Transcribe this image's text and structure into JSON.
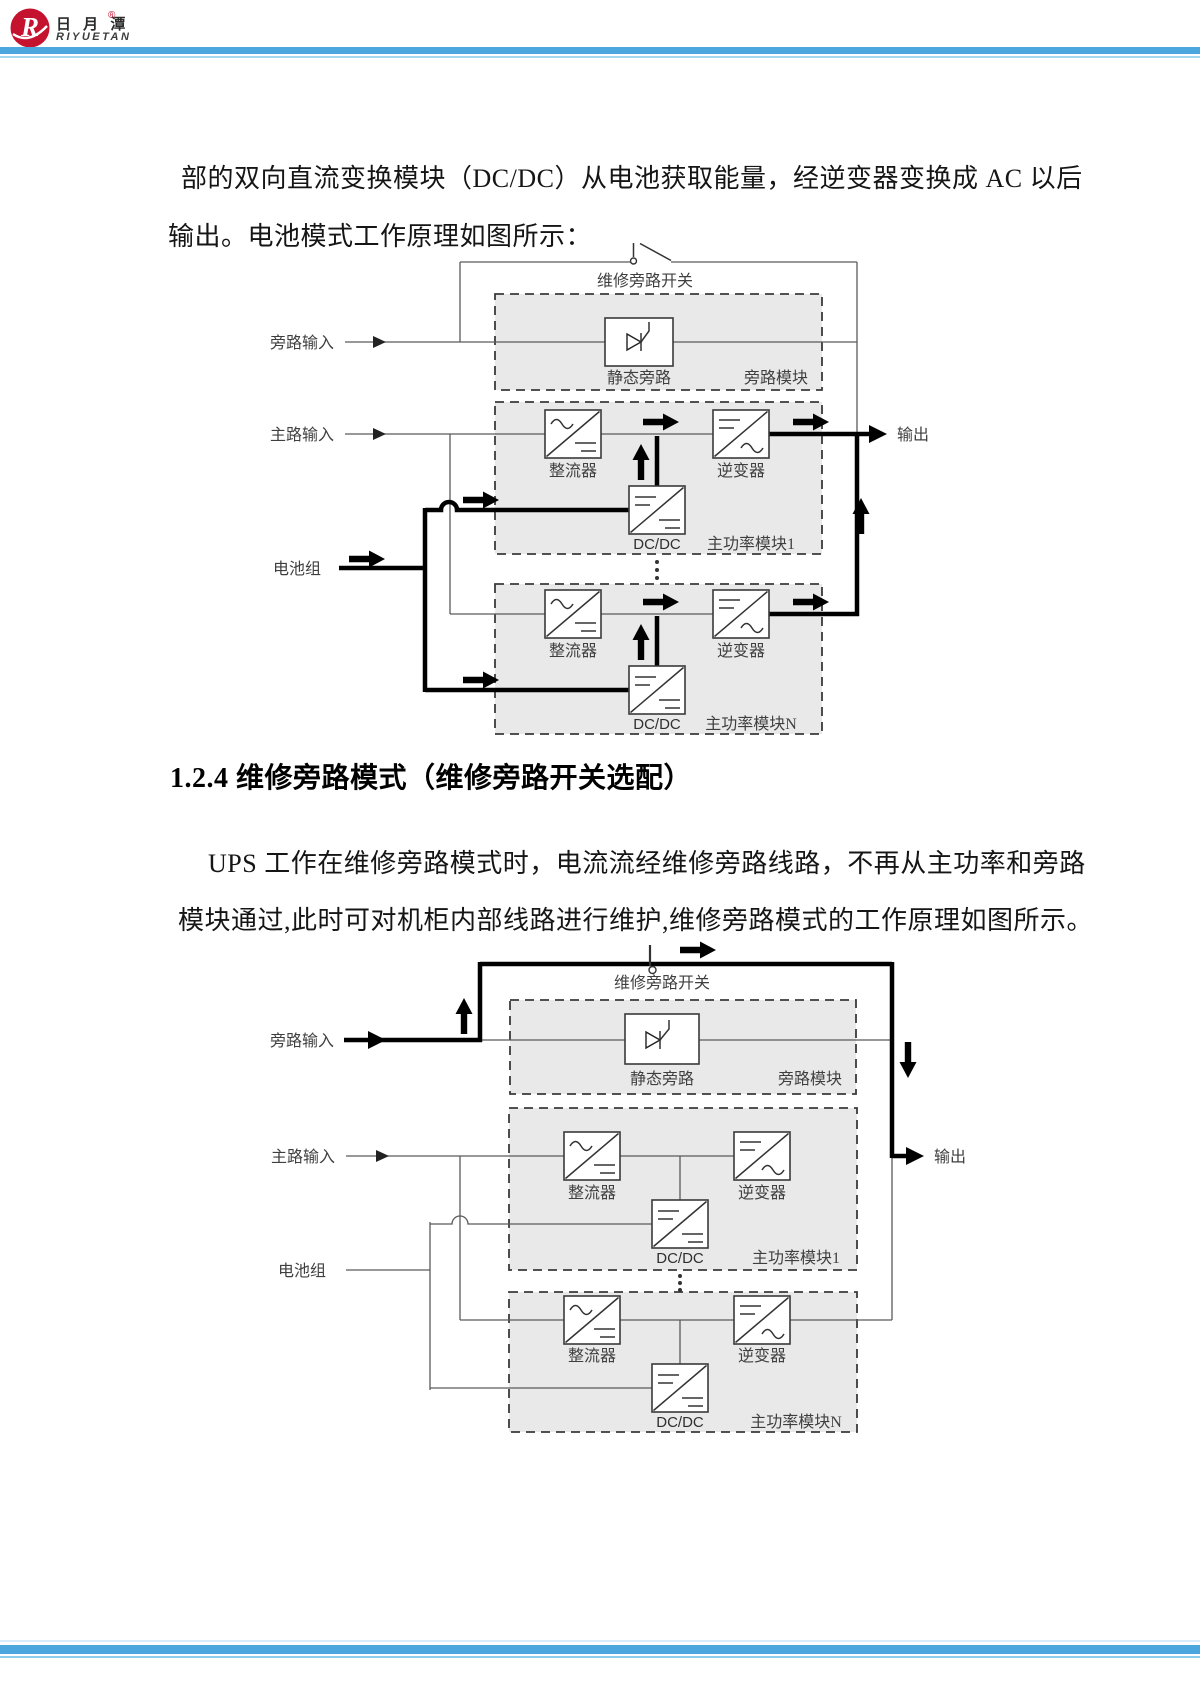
{
  "header": {
    "brand_cn": "日 月 潭",
    "reg": "®",
    "brand_en": "RIYUETAN"
  },
  "intro": {
    "line1": "部的双向直流变换模块（DC/DC）从电池获取能量，经逆变器变换成 AC 以后",
    "line2": "输出。电池模式工作原理如图所示："
  },
  "heading": "1.2.4 维修旁路模式（维修旁路开关选配）",
  "maintenance": {
    "line1": "UPS 工作在维修旁路模式时，电流流经维修旁路线路，不再从主功率和旁路",
    "line2": "模块通过,此时可对机柜内部线路进行维护,维修旁路模式的工作原理如图所示。"
  },
  "diagram1": {
    "switch": "维修旁路开关",
    "bypass_input": "旁路输入",
    "main_input": "主路输入",
    "battery": "电池组",
    "output": "输出",
    "static_bypass": "静态旁路",
    "bypass_module": "旁路模块",
    "rectifier": "整流器",
    "inverter": "逆变器",
    "dcdc": "DC/DC",
    "module1": "主功率模块1",
    "moduleN": "主功率模块N"
  },
  "diagram2": {
    "switch": "维修旁路开关",
    "bypass_input": "旁路输入",
    "main_input": "主路输入",
    "battery": "电池组",
    "output": "输出",
    "static_bypass": "静态旁路",
    "bypass_module": "旁路模块",
    "rectifier": "整流器",
    "inverter": "逆变器",
    "dcdc": "DC/DC",
    "module1": "主功率模块1",
    "moduleN": "主功率模块N"
  },
  "colors": {
    "accent_blue": "#4ba7dd",
    "accent_blue_light": "#a5d7f1",
    "logo_red": "#c5122f",
    "module_fill": "#e9e9e9"
  }
}
